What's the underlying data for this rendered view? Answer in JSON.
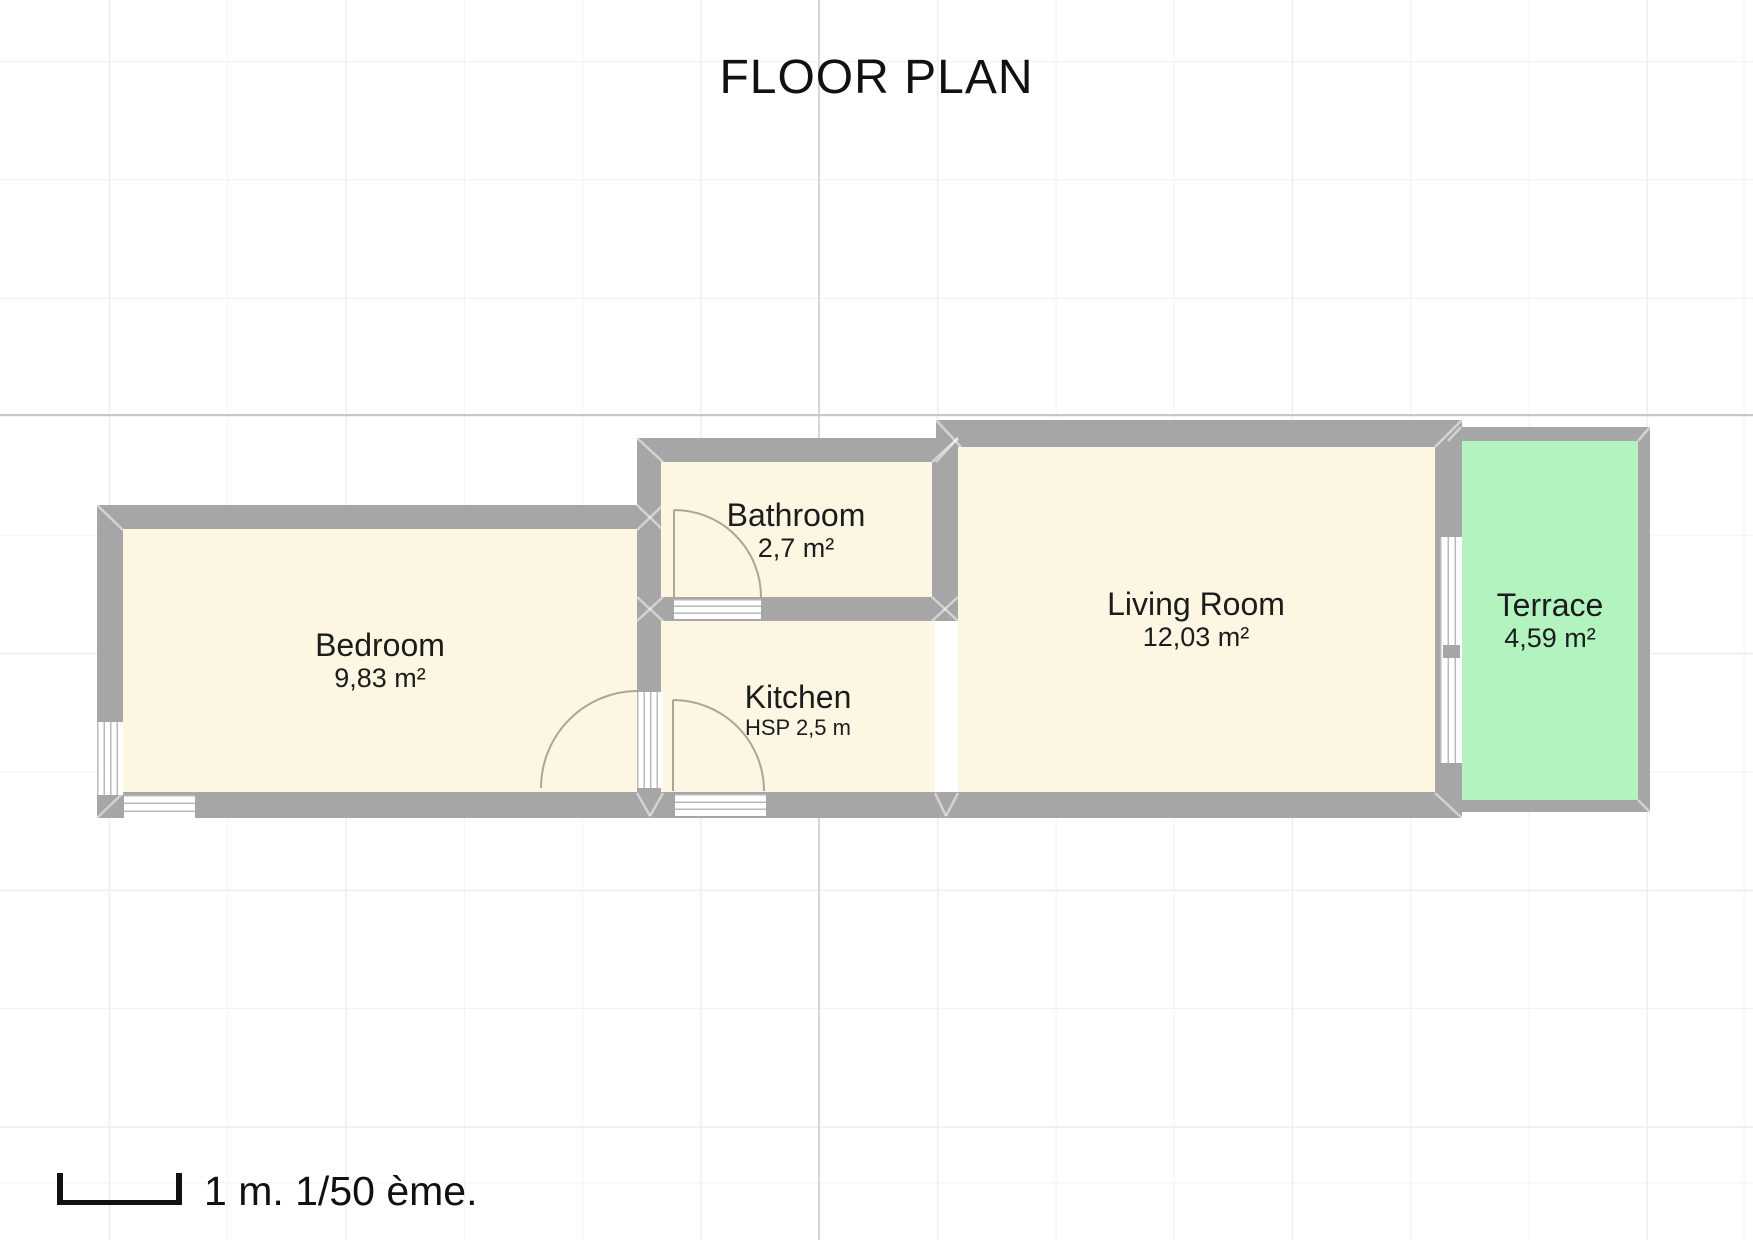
{
  "title": "FLOOR PLAN",
  "rooms": [
    {
      "id": "bedroom",
      "name": "Bedroom",
      "area": "9,83 m²"
    },
    {
      "id": "bathroom",
      "name": "Bathroom",
      "area": "2,7 m²"
    },
    {
      "id": "kitchen",
      "name": "Kitchen",
      "sublabel": "HSP 2,5 m"
    },
    {
      "id": "living-room",
      "name": "Living Room",
      "area": "12,03 m²"
    },
    {
      "id": "terrace",
      "name": "Terrace",
      "area": "4,59 m²"
    }
  ],
  "scale": {
    "label": "1 m. 1/50 ème."
  },
  "colors": {
    "wall": "#a6a6a6",
    "room_fill": "#fcf6e2",
    "terrace_fill": "#b2f3bf",
    "opening_fill": "#ffffff",
    "window_line": "#b9b9b9",
    "door_arc": "#b0a494",
    "grid_line": "#ededed",
    "grid_major_vertical": "#d7d7d7",
    "grid_major_horizontal": "#c7c7c7",
    "text": "#1c1c1c"
  }
}
